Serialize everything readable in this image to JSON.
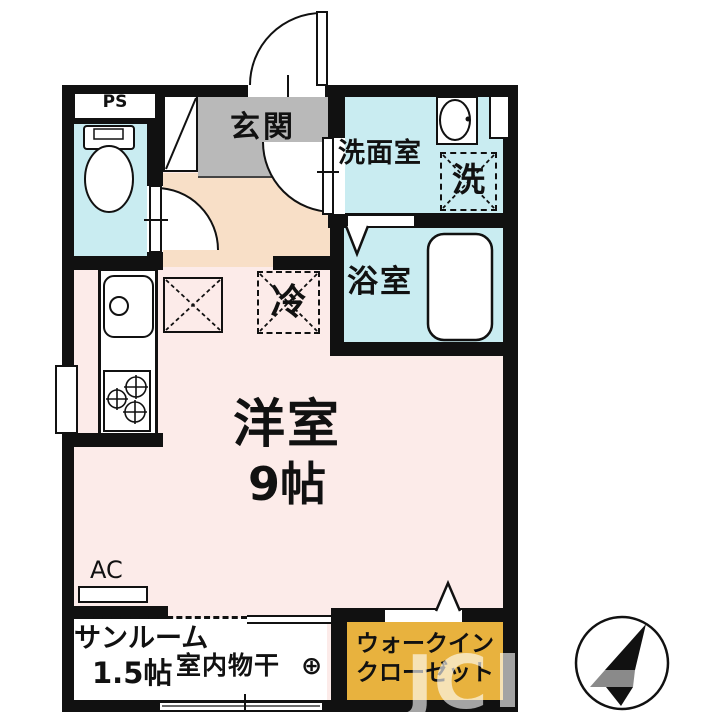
{
  "plan": {
    "ps": "PS",
    "entrance": "玄関",
    "washroom": "洗面室",
    "laundry": "洗",
    "bathroom": "浴室",
    "refrigerator": "冷",
    "main_room": "洋室",
    "main_room_size": "9帖",
    "ac": "AC",
    "sunroom": "サンルーム",
    "sunroom_size": "1.5帖",
    "indoor_drying": "室内物干",
    "indoor_drying_symbol": "⊕",
    "wic_line1": "ウォークイン",
    "wic_line2": "クローゼット"
  },
  "watermark": "JC",
  "colors": {
    "wall": "#111111",
    "wet_area": "#c9ecf1",
    "entrance_floor": "#b9b9b9",
    "hallway": "#f8dfc7",
    "main_room": "#fcebe9",
    "closet": "#e8b23e",
    "sunroom": "#ffffff"
  }
}
